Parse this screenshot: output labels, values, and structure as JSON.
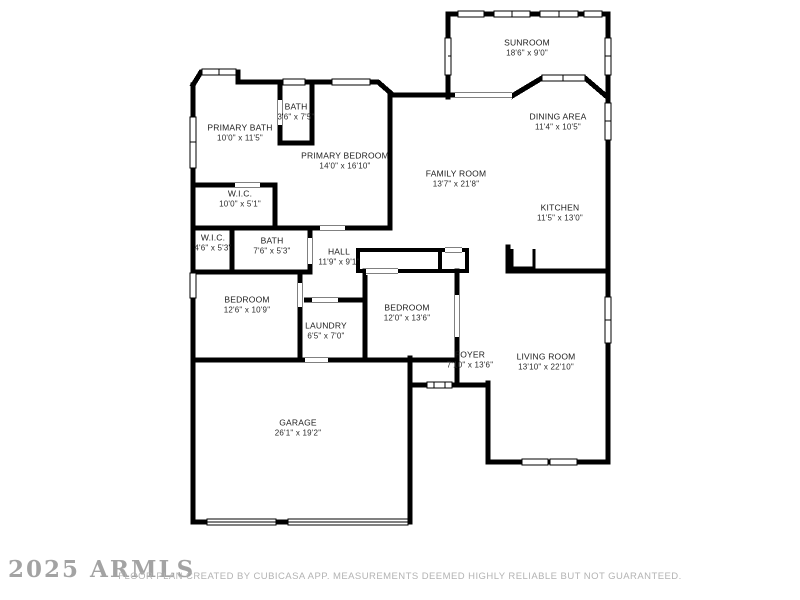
{
  "title": "Residential floor plan",
  "colors": {
    "background": "#ffffff",
    "walls": "#000000",
    "room_text": "#1c1c1c",
    "watermark_text": "#8d8d8d",
    "attribution_text": "#b3b3b3"
  },
  "rooms": [
    {
      "name": "SUNROOM",
      "dims": "18'6\" x 9'0\"",
      "x": 527,
      "y": 48
    },
    {
      "name": "DINING AREA",
      "dims": "11'4\" x 10'5\"",
      "x": 558,
      "y": 122
    },
    {
      "name": "PRIMARY BATH",
      "dims": "10'0\" x 11'5\"",
      "x": 240,
      "y": 133
    },
    {
      "name": "BATH",
      "dims": "3'6\" x 7'5\"",
      "x": 296,
      "y": 112
    },
    {
      "name": "PRIMARY BEDROOM",
      "dims": "14'0\" x 16'10\"",
      "x": 345,
      "y": 161
    },
    {
      "name": "FAMILY ROOM",
      "dims": "13'7\" x 21'8\"",
      "x": 456,
      "y": 179
    },
    {
      "name": "KITCHEN",
      "dims": "11'5\" x 13'0\"",
      "x": 560,
      "y": 213
    },
    {
      "name": "W.I.C.",
      "dims": "10'0\" x 5'1\"",
      "x": 240,
      "y": 199
    },
    {
      "name": "W.I.C.",
      "dims": "4'6\" x 5'3\"",
      "x": 213,
      "y": 243
    },
    {
      "name": "BATH",
      "dims": "7'6\" x 5'3\"",
      "x": 272,
      "y": 246
    },
    {
      "name": "HALL",
      "dims": "11'9\" x 9'1\"",
      "x": 339,
      "y": 257
    },
    {
      "name": "BEDROOM",
      "dims": "12'6\" x 10'9\"",
      "x": 247,
      "y": 305
    },
    {
      "name": "LAUNDRY",
      "dims": "6'5\" x 7'0\"",
      "x": 326,
      "y": 331
    },
    {
      "name": "BEDROOM",
      "dims": "12'0\" x 13'6\"",
      "x": 407,
      "y": 313
    },
    {
      "name": "FOYER",
      "dims": "7'10\" x 13'6\"",
      "x": 470,
      "y": 360
    },
    {
      "name": "LIVING ROOM",
      "dims": "13'10\" x 22'10\"",
      "x": 546,
      "y": 362
    },
    {
      "name": "GARAGE",
      "dims": "26'1\" x 19'2\"",
      "x": 298,
      "y": 428
    }
  ],
  "footer": {
    "watermark": "2025 ARMLS",
    "attribution": "FLOOR PLAN CREATED BY CUBICASA APP. MEASUREMENTS DEEMED HIGHLY RELIABLE BUT NOT GUARANTEED."
  }
}
